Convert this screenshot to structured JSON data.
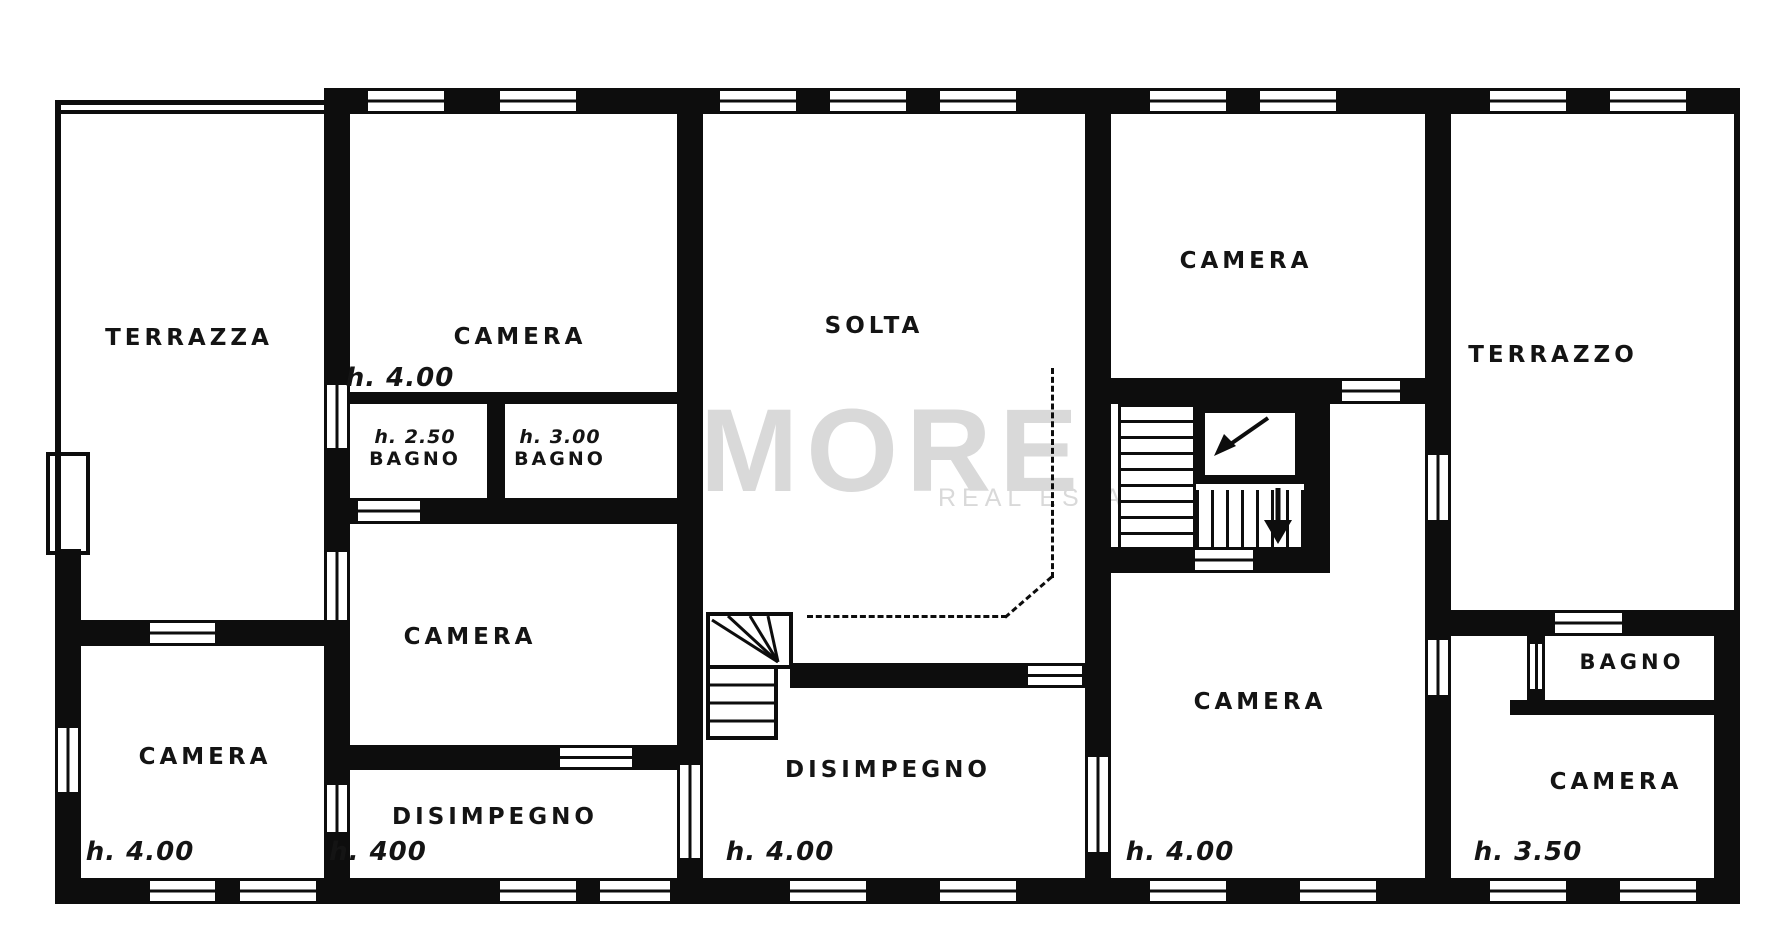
{
  "title": "Apartment attic floor plan",
  "colors": {
    "wall": "#0d0d0d",
    "background": "#ffffff",
    "watermark": "#d9d9d9"
  },
  "watermark": {
    "brand_vertical": "GRUPPO",
    "brand": "MORE",
    "brand_sub": "REAL ESTATE"
  },
  "rooms": [
    {
      "label": "TERRAZZA"
    },
    {
      "label": "CAMERA",
      "height": "h. 4.00"
    },
    {
      "label": "BAGNO",
      "height": "h. 2.50"
    },
    {
      "label": "BAGNO",
      "height": "h. 3.00"
    },
    {
      "label": "SOLTA"
    },
    {
      "label": "CAMERA"
    },
    {
      "label": "TERRAZZO"
    },
    {
      "label": "CAMERA"
    },
    {
      "label": "CAMERA",
      "height": "h. 4.00"
    },
    {
      "label": "DISIMPEGNO",
      "height": "h. 400"
    },
    {
      "label": "DISIMPEGNO",
      "height": "h. 4.00"
    },
    {
      "label": "CAMERA",
      "height": "h. 4.00"
    },
    {
      "label": "BAGNO"
    },
    {
      "label": "CAMERA",
      "height": "h. 3.50"
    }
  ]
}
